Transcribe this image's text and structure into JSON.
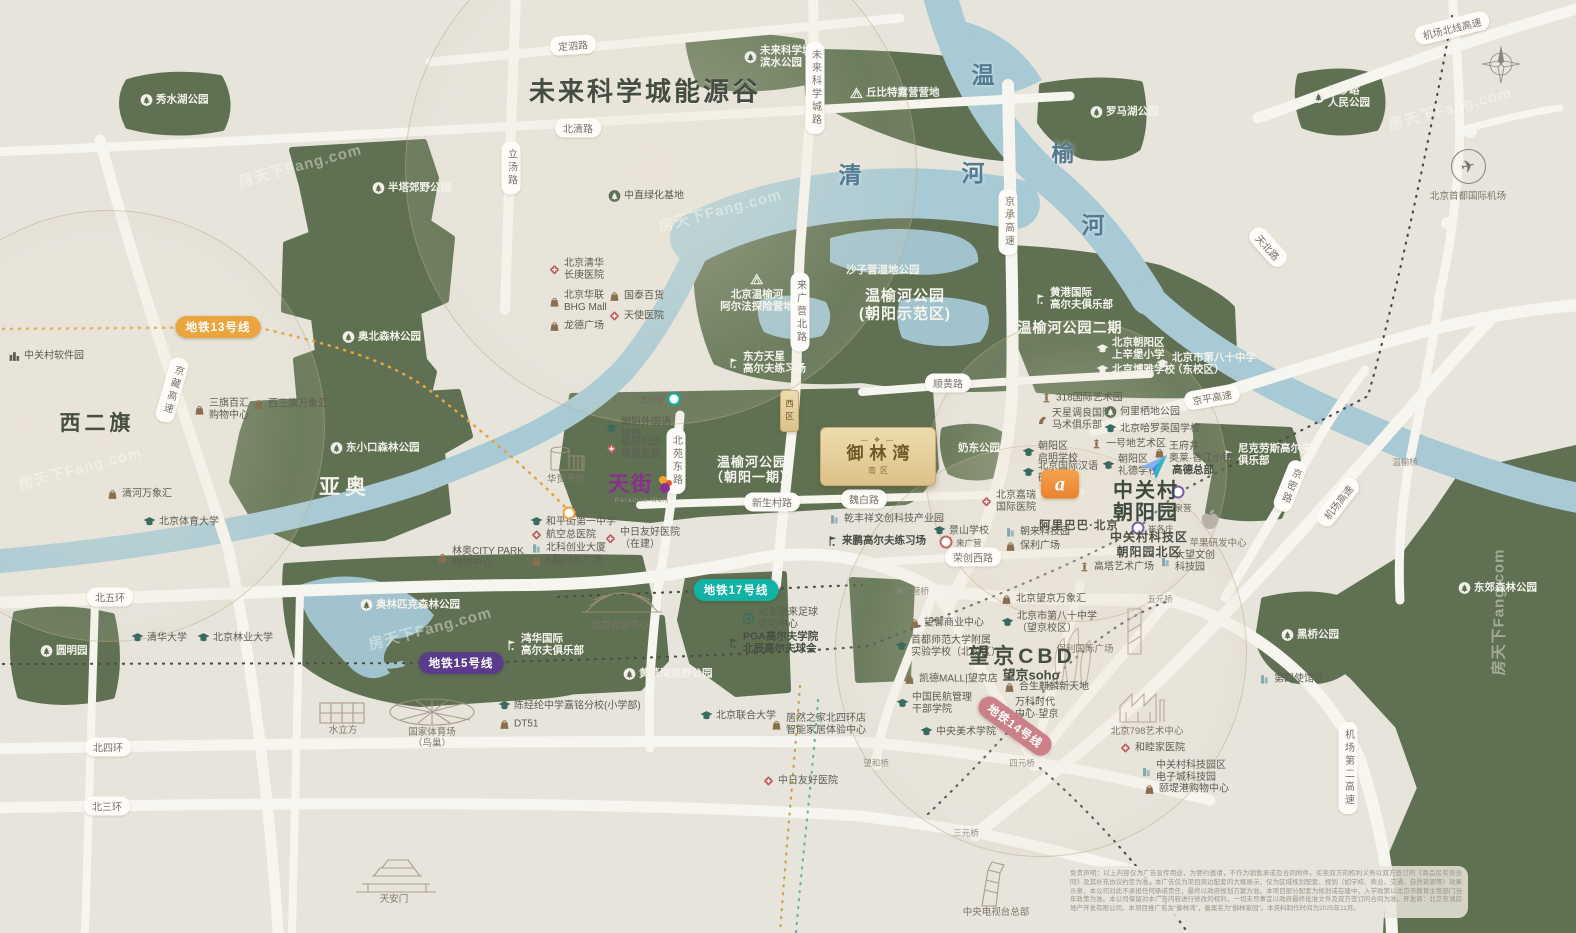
{
  "colors": {
    "background": "#e7e4dc",
    "park": "#5f7152",
    "water": "#a7cad5",
    "road": "#f7f5ef",
    "metro13": "#eca43e",
    "metro15": "#5b3b8c",
    "metro17": "#13b2a7",
    "metro14": "#cb8187",
    "project_gold": "#dcc189",
    "alibaba_orange": "#ea8230",
    "tianjie_purple": "#87308d"
  },
  "project": {
    "name": "御林湾",
    "ornament": "— ❖ —",
    "district_south": "南区",
    "district_west": "西区"
  },
  "tianjie": {
    "name": "天街",
    "sub": "Paradise Walk"
  },
  "alibaba": {
    "logo_char": "a",
    "name": "阿里巴巴·北京"
  },
  "zgc": {
    "line1": "中关村",
    "line2": "朝阳园",
    "sub1": "中关村科技区",
    "sub2": "朝阳园北区"
  },
  "airport_label": "北京首都国际机场",
  "watermark": {
    "text": "房天下Fang.com",
    "spots": [
      {
        "x": 300,
        "y": 165,
        "r": -15
      },
      {
        "x": 720,
        "y": 210,
        "r": -15
      },
      {
        "x": 430,
        "y": 628,
        "r": -15
      },
      {
        "x": 1450,
        "y": 108,
        "r": -15
      },
      {
        "x": 1498,
        "y": 612,
        "r": -90
      },
      {
        "x": 80,
        "y": 468,
        "r": -15
      }
    ]
  },
  "disclaimer": "免责声明：以上内容仅为广告宣传用途，为要约邀请，不作为销售承诺及合同附件。买卖双方的权利义务以双方签订的《商品房买卖合同》及其补充协议约定为准。本广告仅为项目周边配套的大概展示，仅为区域规划配套、规划（如学校、商业、交通、自然资源等）效果示意，本公司对此不承担任何承诺责任，最终以政府规划方案为准。本项目部分配套为规划或在建中，入学政策以北京市教育主管部门当年政策为准。本公司保留对本广告内容进行修改的权利，一切未尽事宜以政府最终批准文件及双方签订的合同为准。开发商：北京东湖房地产开发有限公司。本项目推广名为“御林湾”，备案名为“御林家园”。本资料制作时间为2025年11月。",
  "labels": [
    {
      "t": "秀水湖公园",
      "x": 140,
      "y": 100,
      "k": "pw",
      "i": "treew"
    },
    {
      "t": "未来科学城",
      "u": "滨水公园",
      "x": 744,
      "y": 57,
      "k": "pw",
      "i": "treew"
    },
    {
      "t": "丘比特露营营地",
      "x": 850,
      "y": 93,
      "k": "pw",
      "i": "tent"
    },
    {
      "t": "罗马湖公园",
      "x": 1090,
      "y": 112,
      "k": "pw",
      "i": "treew"
    },
    {
      "t": "后沙峪",
      "u": "人民公园",
      "x": 1312,
      "y": 97,
      "k": "pw",
      "i": "treew"
    },
    {
      "t": "半塔郊野公园",
      "x": 372,
      "y": 188,
      "k": "pw",
      "i": "treew"
    },
    {
      "t": "奥北森林公园",
      "x": 342,
      "y": 337,
      "k": "pw",
      "i": "treew"
    },
    {
      "t": "东小口森林公园",
      "x": 330,
      "y": 448,
      "k": "pw",
      "i": "treew"
    },
    {
      "t": "奥林匹克森林公园",
      "x": 360,
      "y": 605,
      "k": "pw",
      "i": "treew"
    },
    {
      "t": "圆明园",
      "x": 40,
      "y": 651,
      "k": "pw",
      "i": "treew"
    },
    {
      "t": "黄草湾郊野公园",
      "x": 623,
      "y": 674,
      "k": "pw",
      "i": "treew"
    },
    {
      "t": "东郊森林公园",
      "x": 1458,
      "y": 588,
      "k": "pw",
      "i": "treew"
    },
    {
      "t": "黑桥公园",
      "x": 1281,
      "y": 635,
      "k": "pw",
      "i": "treew"
    },
    {
      "t": "奶东公园",
      "x": 958,
      "y": 448,
      "k": "pw"
    },
    {
      "t": "沙子营湿地公园",
      "x": 846,
      "y": 270,
      "k": "pw"
    },
    {
      "t": "北京温榆河",
      "u": "阿尔法探险营地",
      "x": 757,
      "y": 293,
      "k": "pwv",
      "i": "tent"
    },
    {
      "t": "东方天星",
      "u": "高尔夫练习场",
      "x": 727,
      "y": 363,
      "k": "pwb",
      "i": "golfw"
    },
    {
      "t": "黄港国际",
      "u": "高尔夫俱乐部",
      "x": 1034,
      "y": 299,
      "k": "pwb",
      "i": "golfw"
    },
    {
      "t": "尼克劳斯高尔夫",
      "u": "俱乐部",
      "x": 1222,
      "y": 455,
      "k": "pwb",
      "i": "golfw"
    },
    {
      "t": "鸿华国际",
      "u": "高尔夫俱乐部",
      "x": 505,
      "y": 645,
      "k": "pwb",
      "i": "golfw"
    },
    {
      "t": "温榆河公园",
      "u": "(朝阳示范区)",
      "x": 905,
      "y": 305,
      "k": "pwt",
      "s": 15
    },
    {
      "t": "温榆河公园",
      "u": "（朝阳一期）",
      "x": 752,
      "y": 470,
      "k": "pwt",
      "s": 13
    },
    {
      "t": "温榆河公园二期",
      "x": 1070,
      "y": 328,
      "k": "pwt",
      "s": 14
    },
    {
      "t": "北京朝阳区",
      "u": "上辛堡小学",
      "x": 1096,
      "y": 349,
      "k": "pw",
      "i": "schoolw"
    },
    {
      "t": "北京博雅学校",
      "x": 1096,
      "y": 370,
      "k": "pw",
      "i": "schoolw"
    },
    {
      "t": "北京市第八十中学",
      "u": "（东校区）",
      "x": 1156,
      "y": 364,
      "k": "pw",
      "i": "schoolw"
    },
    {
      "t": "中直绿化基地",
      "x": 608,
      "y": 196,
      "k": "poi",
      "i": "treeg"
    },
    {
      "t": "北京清华",
      "u": "长庚医院",
      "x": 548,
      "y": 270,
      "k": "poi",
      "i": "hosp"
    },
    {
      "t": "北京华联",
      "u": "BHG Mall",
      "x": 548,
      "y": 302,
      "k": "poi",
      "i": "mall"
    },
    {
      "t": "国泰百货",
      "x": 608,
      "y": 296,
      "k": "poi",
      "i": "mall"
    },
    {
      "t": "天使医院",
      "x": 608,
      "y": 316,
      "k": "poi",
      "i": "hosp"
    },
    {
      "t": "龙德广场",
      "x": 548,
      "y": 326,
      "k": "poi",
      "i": "mall"
    },
    {
      "t": "中关村软件园",
      "x": 8,
      "y": 356,
      "k": "poi",
      "i": "bldgs"
    },
    {
      "t": "三旗百汇",
      "u": "购物中心",
      "x": 193,
      "y": 410,
      "k": "poi",
      "i": "mall"
    },
    {
      "t": "西三旗万象汇",
      "x": 252,
      "y": 404,
      "k": "poi",
      "i": "mall"
    },
    {
      "t": "清河万象汇",
      "x": 106,
      "y": 494,
      "k": "poi",
      "i": "mall"
    },
    {
      "t": "北京体育大学",
      "x": 143,
      "y": 522,
      "k": "poi",
      "i": "school"
    },
    {
      "t": "清华大学",
      "x": 131,
      "y": 638,
      "k": "poi",
      "i": "school"
    },
    {
      "t": "北京林业大学",
      "x": 197,
      "y": 638,
      "k": "poi",
      "i": "school"
    },
    {
      "t": "朝阳外国语",
      "u": "学校",
      "x": 605,
      "y": 429,
      "k": "poi",
      "i": "school"
    },
    {
      "t": "朝阳妇幼",
      "u": "保健医院",
      "x": 605,
      "y": 449,
      "k": "poi",
      "i": "hosp"
    },
    {
      "t": "和平街第一中学",
      "x": 530,
      "y": 522,
      "k": "poi",
      "i": "school"
    },
    {
      "t": "航空总医院",
      "x": 530,
      "y": 535,
      "k": "poi",
      "i": "hosp"
    },
    {
      "t": "北科创业大厦",
      "x": 530,
      "y": 548,
      "k": "poi",
      "i": "office"
    },
    {
      "t": "K酷时尚广场",
      "x": 530,
      "y": 561,
      "k": "poi",
      "i": "mall"
    },
    {
      "t": "中日友好医院",
      "u": "（在建）",
      "x": 604,
      "y": 539,
      "k": "poi",
      "i": "hosp"
    },
    {
      "t": "林奥CITY PARK",
      "u": "购物中心",
      "x": 436,
      "y": 558,
      "k": "poi",
      "i": "mall"
    },
    {
      "t": "陈经纶中学嘉铭分校(小学部)",
      "x": 498,
      "y": 706,
      "k": "poi",
      "i": "school"
    },
    {
      "t": "DT51",
      "x": 498,
      "y": 724,
      "k": "poi",
      "i": "mall"
    },
    {
      "t": "北京联合大学",
      "x": 700,
      "y": 716,
      "k": "poi",
      "i": "school"
    },
    {
      "t": "居然之家北四环店",
      "u": "智能家居体验中心",
      "x": 770,
      "y": 725,
      "k": "poi",
      "i": "mall"
    },
    {
      "t": "PGA高尔夫学院",
      "u": "北辰高尔夫球会",
      "x": 727,
      "y": 643,
      "k": "poib",
      "i": "golf"
    },
    {
      "t": "北京朝来足球",
      "u": "活动中心",
      "x": 742,
      "y": 619,
      "k": "poi",
      "i": "soccer"
    },
    {
      "t": "水立方",
      "x": 343,
      "y": 729,
      "k": "cap"
    },
    {
      "t": "国家体育场",
      "u": "（鸟巢）",
      "x": 432,
      "y": 738,
      "k": "cap"
    },
    {
      "t": "天安门",
      "x": 394,
      "y": 898,
      "k": "cap"
    },
    {
      "t": "北京会议中心",
      "x": 620,
      "y": 624,
      "k": "cap"
    },
    {
      "t": "华贸天地",
      "x": 566,
      "y": 478,
      "k": "cap"
    },
    {
      "t": "中日友好医院",
      "x": 762,
      "y": 781,
      "k": "poi",
      "i": "hosp"
    },
    {
      "t": "中央电视台总部",
      "x": 996,
      "y": 911,
      "k": "cap"
    },
    {
      "t": "望馨商业中心",
      "x": 908,
      "y": 623,
      "k": "poi",
      "i": "mall"
    },
    {
      "t": "首都师范大学附属",
      "u": "实验学校（北校区）",
      "x": 895,
      "y": 647,
      "k": "poi",
      "i": "school"
    },
    {
      "t": "凯德MALL|望京店",
      "x": 903,
      "y": 679,
      "k": "poi",
      "i": "mall"
    },
    {
      "t": "中国民航管理",
      "u": "干部学院",
      "x": 896,
      "y": 704,
      "k": "poi",
      "i": "school"
    },
    {
      "t": "中央美术学院",
      "x": 920,
      "y": 732,
      "k": "poi",
      "i": "school"
    },
    {
      "t": "北京望京万象汇",
      "x": 1000,
      "y": 599,
      "k": "poi",
      "i": "mall"
    },
    {
      "t": "北京市第八十中学",
      "u": "（望京校区）",
      "x": 1001,
      "y": 623,
      "k": "poi",
      "i": "school"
    },
    {
      "t": "保利国际广场",
      "x": 1085,
      "y": 648,
      "k": "cap"
    },
    {
      "t": "合生麒麟新天地",
      "x": 1003,
      "y": 687,
      "k": "poi",
      "i": "mall"
    },
    {
      "t": "万科时代",
      "u": "中心·望京",
      "x": 999,
      "y": 709,
      "k": "poi",
      "i": "office"
    },
    {
      "t": "北京798艺术中心",
      "x": 1147,
      "y": 730,
      "k": "cap"
    },
    {
      "t": "和睦家医院",
      "x": 1119,
      "y": 748,
      "k": "poi",
      "i": "hosp"
    },
    {
      "t": "中关村科技园区",
      "u": "电子城科技园",
      "x": 1140,
      "y": 772,
      "k": "poi",
      "i": "office"
    },
    {
      "t": "颐堤港购物中心",
      "x": 1143,
      "y": 789,
      "k": "poi",
      "i": "mall"
    },
    {
      "t": "第四使馆区",
      "x": 1258,
      "y": 679,
      "k": "poi",
      "i": "office"
    },
    {
      "t": "318国际艺术园",
      "x": 1040,
      "y": 398,
      "k": "poi",
      "i": "tower"
    },
    {
      "t": "天星调良国际",
      "u": "马术俱乐部",
      "x": 1036,
      "y": 420,
      "k": "poi",
      "i": "horse"
    },
    {
      "t": "何里栖地公园",
      "x": 1104,
      "y": 412,
      "k": "poi",
      "i": "treeg"
    },
    {
      "t": "北京哈罗英国学校",
      "x": 1104,
      "y": 429,
      "k": "poi",
      "i": "school"
    },
    {
      "t": "一号地艺术区",
      "x": 1090,
      "y": 444,
      "k": "poi",
      "i": "tower"
    },
    {
      "t": "王府井",
      "u": "奥莱·香江小镇",
      "x": 1153,
      "y": 453,
      "k": "poi",
      "i": "mall"
    },
    {
      "t": "朝阳区",
      "u": "启明学校",
      "x": 1022,
      "y": 453,
      "k": "poi",
      "i": "school"
    },
    {
      "t": "北京国际汉语",
      "u": "研修学院",
      "x": 1022,
      "y": 473,
      "k": "poi",
      "i": "school"
    },
    {
      "t": "朝阳区",
      "u": "礼德学校",
      "x": 1102,
      "y": 466,
      "k": "poi",
      "i": "school"
    },
    {
      "t": "景山学校",
      "x": 933,
      "y": 531,
      "k": "poi",
      "i": "school"
    },
    {
      "t": "北京嘉瑞",
      "u": "国际医院",
      "x": 980,
      "y": 502,
      "k": "poi",
      "i": "hosp"
    },
    {
      "t": "朝来科技园",
      "x": 1004,
      "y": 532,
      "k": "poi",
      "i": "office"
    },
    {
      "t": "保利广场",
      "x": 1004,
      "y": 546,
      "k": "poi",
      "i": "mall"
    },
    {
      "t": "乾丰祥文创科技产业园",
      "x": 828,
      "y": 519,
      "k": "poi",
      "i": "office"
    },
    {
      "t": "来鹏高尔夫练习场",
      "x": 826,
      "y": 541,
      "k": "poib",
      "i": "golf"
    },
    {
      "t": "高塔艺术广场",
      "x": 1078,
      "y": 567,
      "k": "poi",
      "i": "tower"
    },
    {
      "t": "大望文创",
      "u": "科技园",
      "x": 1159,
      "y": 562,
      "k": "poi",
      "i": "office"
    },
    {
      "t": "苹果研发中心",
      "x": 1218,
      "y": 542,
      "k": "cap"
    },
    {
      "t": "高德总部",
      "x": 1172,
      "y": 470,
      "k": "poib"
    },
    {
      "t": "未来科学城能源谷",
      "x": 645,
      "y": 90,
      "k": "xl"
    },
    {
      "t": "西二旗",
      "x": 97,
      "y": 422,
      "k": "lg"
    },
    {
      "t": "亚奥",
      "x": 345,
      "y": 486,
      "k": "lgw"
    },
    {
      "t": "望京CBD",
      "x": 1022,
      "y": 655,
      "k": "lg"
    },
    {
      "t": "望京soho",
      "x": 1031,
      "y": 674,
      "k": "drk"
    },
    {
      "t": "清",
      "x": 850,
      "y": 173,
      "k": "char"
    },
    {
      "t": "河",
      "x": 973,
      "y": 171,
      "k": "char"
    },
    {
      "t": "温",
      "x": 983,
      "y": 73,
      "k": "char"
    },
    {
      "t": "榆",
      "x": 1063,
      "y": 151,
      "k": "char"
    },
    {
      "t": "河",
      "x": 1093,
      "y": 223,
      "k": "char"
    },
    {
      "t": "定泗路",
      "x": 573,
      "y": 45,
      "k": "pill",
      "r": -4
    },
    {
      "t": "北清路",
      "x": 578,
      "y": 128,
      "k": "pill"
    },
    {
      "t": "顺黄路",
      "x": 948,
      "y": 383,
      "k": "pill"
    },
    {
      "t": "新生村路",
      "x": 772,
      "y": 502,
      "k": "pill"
    },
    {
      "t": "魏白路",
      "x": 864,
      "y": 499,
      "k": "pill"
    },
    {
      "t": "荣创西路",
      "x": 973,
      "y": 557,
      "k": "pill"
    },
    {
      "t": "北五环",
      "x": 110,
      "y": 597,
      "k": "pill"
    },
    {
      "t": "北四环",
      "x": 108,
      "y": 747,
      "k": "pill"
    },
    {
      "t": "北三环",
      "x": 107,
      "y": 806,
      "k": "pill"
    },
    {
      "t": "机场北线高速",
      "x": 1452,
      "y": 28,
      "k": "pill",
      "r": -14
    },
    {
      "t": "京平高速",
      "x": 1212,
      "y": 397,
      "k": "pill",
      "r": -10
    },
    {
      "t": "天北路",
      "x": 1268,
      "y": 247,
      "k": "pill",
      "r": 48
    },
    {
      "t": "机场高速",
      "x": 1338,
      "y": 502,
      "k": "pill",
      "r": -52
    },
    {
      "t": "机场第二高速",
      "x": 1348,
      "y": 768,
      "k": "vpill"
    },
    {
      "t": "立汤路",
      "x": 511,
      "y": 168,
      "k": "vpill"
    },
    {
      "t": "未来科学城路",
      "x": 815,
      "y": 88,
      "k": "vpill"
    },
    {
      "t": "来广营北路",
      "x": 800,
      "y": 312,
      "k": "vpill"
    },
    {
      "t": "北苑东路",
      "x": 676,
      "y": 461,
      "k": "vpill"
    },
    {
      "t": "京承高速",
      "x": 1008,
      "y": 222,
      "k": "vpill"
    },
    {
      "t": "京藏高速",
      "x": 172,
      "y": 390,
      "k": "vpill",
      "r": 16
    },
    {
      "t": "京密路",
      "x": 1290,
      "y": 486,
      "k": "vpill",
      "r": 22
    },
    {
      "t": "地铁13号线",
      "x": 218,
      "y": 327,
      "k": "metro",
      "c": "#eca43e"
    },
    {
      "t": "地铁15号线",
      "x": 461,
      "y": 663,
      "k": "metro",
      "c": "#5b3b8c"
    },
    {
      "t": "地铁17号线",
      "x": 736,
      "y": 590,
      "k": "metro",
      "c": "#13b2a7"
    },
    {
      "t": "地铁14号线",
      "x": 1015,
      "y": 726,
      "k": "metro",
      "c": "#cb8187",
      "r": 36
    },
    {
      "t": "清河营",
      "x": 674,
      "y": 399,
      "k": "station",
      "c": "#13b2a7",
      "d": "left"
    },
    {
      "t": "北苑",
      "x": 569,
      "y": 513,
      "k": "station",
      "c": "#eca43e",
      "d": "right"
    },
    {
      "t": "马泉营",
      "x": 1178,
      "y": 492,
      "k": "station",
      "c": "#7b5ea7",
      "d": "below"
    },
    {
      "t": "崔各庄",
      "x": 1138,
      "y": 528,
      "k": "station",
      "c": "#7b5ea7",
      "d": "right"
    },
    {
      "t": "来广营",
      "x": 946,
      "y": 542,
      "k": "station",
      "c": "#c06a6a",
      "d": "right"
    },
    {
      "t": "来广营桥",
      "x": 912,
      "y": 591,
      "k": "bridge"
    },
    {
      "t": "望和桥",
      "x": 876,
      "y": 763,
      "k": "bridge"
    },
    {
      "t": "四元桥",
      "x": 1022,
      "y": 763,
      "k": "bridge"
    },
    {
      "t": "三元桥",
      "x": 966,
      "y": 833,
      "k": "bridge"
    },
    {
      "t": "五元桥",
      "x": 1160,
      "y": 599,
      "k": "bridge"
    },
    {
      "t": "温榆桥",
      "x": 1405,
      "y": 462,
      "k": "bridge"
    }
  ]
}
